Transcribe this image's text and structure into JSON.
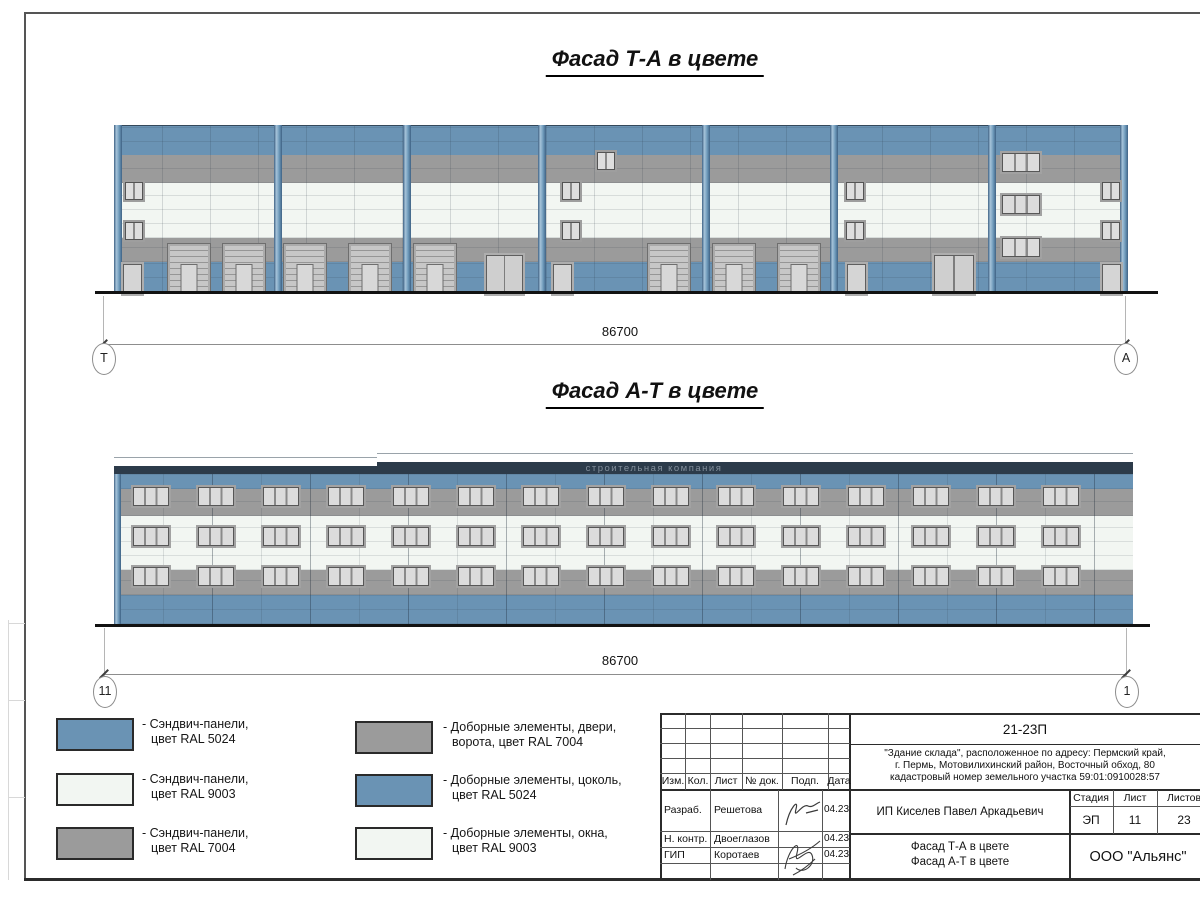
{
  "colors": {
    "ral5024": "#6a93b4",
    "ral9003": "#f2f6f2",
    "ral7004": "#9b9b9b",
    "parapet": "#2c3b4a",
    "ground": "#121212"
  },
  "titles": {
    "facade1": "Фасад Т-А в цвете",
    "facade2": "Фасад А-Т в цвете"
  },
  "facade1": {
    "dimension": "86700",
    "axis_left": "Т",
    "axis_right": "А",
    "pilasters": [
      0,
      160,
      289,
      424,
      588,
      716,
      874,
      1006
    ],
    "elements": [
      {
        "t": "gate",
        "x": 53,
        "y": 118,
        "w": 42,
        "h": 49
      },
      {
        "t": "gate",
        "x": 108,
        "y": 118,
        "w": 42,
        "h": 49
      },
      {
        "t": "gate",
        "x": 169,
        "y": 118,
        "w": 42,
        "h": 49
      },
      {
        "t": "gate",
        "x": 234,
        "y": 118,
        "w": 42,
        "h": 49
      },
      {
        "t": "gate",
        "x": 299,
        "y": 118,
        "w": 42,
        "h": 49
      },
      {
        "t": "gate",
        "x": 533,
        "y": 118,
        "w": 42,
        "h": 49
      },
      {
        "t": "gate",
        "x": 598,
        "y": 118,
        "w": 42,
        "h": 49
      },
      {
        "t": "gate",
        "x": 663,
        "y": 118,
        "w": 42,
        "h": 49
      },
      {
        "t": "ddoor",
        "x": 372,
        "y": 130,
        "w": 35,
        "h": 37
      },
      {
        "t": "ddoor",
        "x": 820,
        "y": 130,
        "w": 38,
        "h": 37
      },
      {
        "t": "door",
        "x": 9,
        "y": 139,
        "w": 17,
        "h": 28
      },
      {
        "t": "door",
        "x": 439,
        "y": 139,
        "w": 17,
        "h": 28
      },
      {
        "t": "door",
        "x": 733,
        "y": 139,
        "w": 17,
        "h": 28
      },
      {
        "t": "door",
        "x": 988,
        "y": 139,
        "w": 17,
        "h": 28
      },
      {
        "t": "w2",
        "x": 11,
        "y": 57,
        "w": 16,
        "h": 16
      },
      {
        "t": "w2",
        "x": 11,
        "y": 97,
        "w": 16,
        "h": 16
      },
      {
        "t": "w2",
        "x": 448,
        "y": 57,
        "w": 16,
        "h": 16
      },
      {
        "t": "w2",
        "x": 448,
        "y": 97,
        "w": 16,
        "h": 16
      },
      {
        "t": "w2",
        "x": 483,
        "y": 27,
        "w": 16,
        "h": 16
      },
      {
        "t": "w2",
        "x": 732,
        "y": 57,
        "w": 16,
        "h": 16
      },
      {
        "t": "w2",
        "x": 732,
        "y": 97,
        "w": 16,
        "h": 16
      },
      {
        "t": "w2",
        "x": 988,
        "y": 57,
        "w": 16,
        "h": 16
      },
      {
        "t": "w2",
        "x": 988,
        "y": 97,
        "w": 16,
        "h": 16
      },
      {
        "t": "w3",
        "x": 888,
        "y": 28,
        "w": 36,
        "h": 17
      },
      {
        "t": "w3",
        "x": 888,
        "y": 70,
        "w": 36,
        "h": 17
      },
      {
        "t": "w3",
        "x": 888,
        "y": 113,
        "w": 36,
        "h": 17
      }
    ]
  },
  "facade2": {
    "dimension": "86700",
    "axis_left": "11",
    "axis_right": "1",
    "window_grid": {
      "start": 19,
      "spacing": 65,
      "count": 15,
      "w": 34,
      "h": 17,
      "rows": [
        34,
        74,
        114
      ]
    },
    "watermark": "строительная компания"
  },
  "legend": {
    "items": [
      {
        "color": "#6a93b4",
        "line1": "- Сэндвич-панели,",
        "line2": "цвет RAL 5024"
      },
      {
        "color": "#f2f6f2",
        "line1": "- Сэндвич-панели,",
        "line2": "цвет RAL 9003"
      },
      {
        "color": "#9b9b9b",
        "line1": "- Сэндвич-панели,",
        "line2": "цвет RAL 7004"
      },
      {
        "color": "#9b9b9b",
        "line1": "- Доборные элементы, двери,",
        "line2": "ворота, цвет RAL 7004"
      },
      {
        "color": "#6a93b4",
        "line1": "- Доборные элементы, цоколь,",
        "line2": "цвет RAL 5024"
      },
      {
        "color": "#f2f6f2",
        "line1": "- Доборные элементы, окна,",
        "line2": "цвет RAL 9003"
      }
    ]
  },
  "stamp": {
    "doc_number": "21-23П",
    "address_line1": "\"Здание склада\", расположенное по адресу: Пермский край,",
    "address_line2": "г. Пермь, Мотовилихинский район, Восточный обход, 80",
    "address_line3": "кадастровый номер земельного участка 59:01:0910028:57",
    "rev_headers": [
      "Изм.",
      "Кол.",
      "Лист",
      "№ док.",
      "Подп.",
      "Дата"
    ],
    "roles": [
      {
        "role": "Разраб.",
        "name": "Решетова",
        "date": "04.23"
      },
      {
        "role": "Н. контр.",
        "name": "Двоеглазов",
        "date": "04.23"
      },
      {
        "role": "ГИП",
        "name": "Коротаев",
        "date": "04.23"
      }
    ],
    "client": "ИП Киселев Павел Аркадьевич",
    "stage_label": "Стадия",
    "sheet_label": "Лист",
    "sheets_label": "Листов",
    "stage": "ЭП",
    "sheet": "11",
    "sheets": "23",
    "sheet_name_line1": "Фасад Т-А в цвете",
    "sheet_name_line2": "Фасад А-Т в цвете",
    "org": "ООО \"Альянс\""
  }
}
